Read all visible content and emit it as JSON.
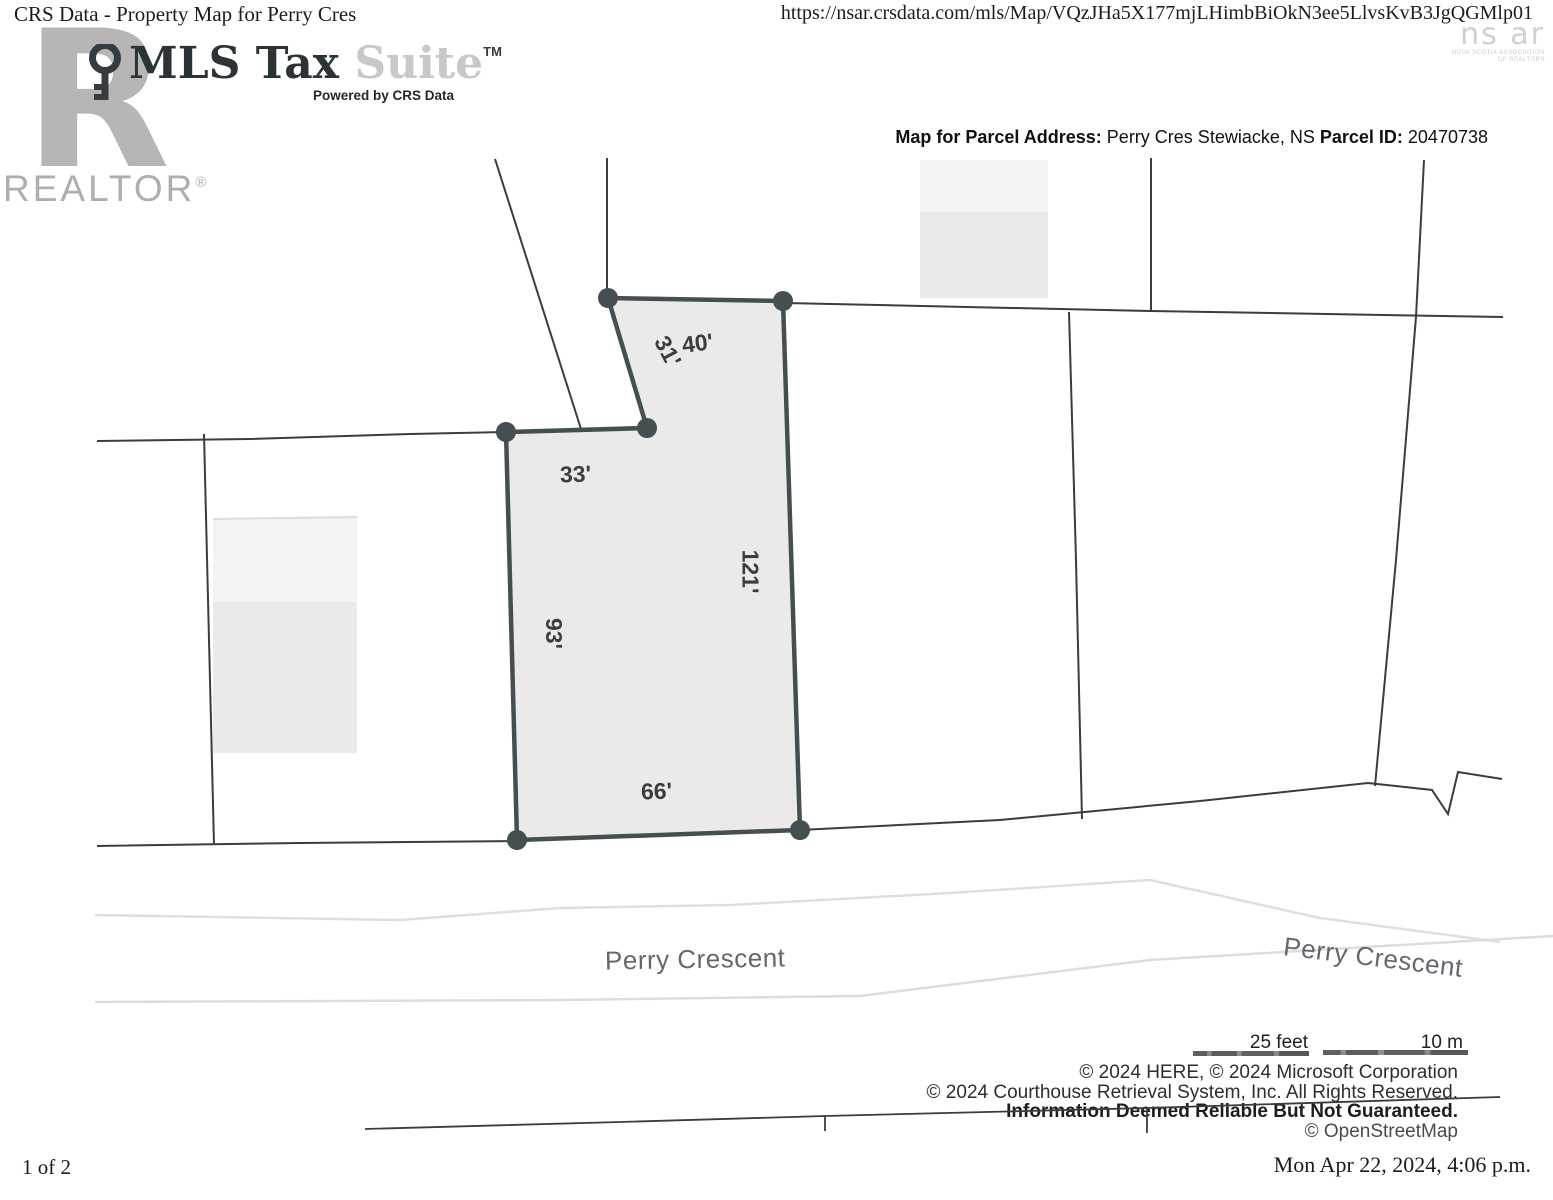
{
  "print_header": {
    "title": "CRS Data - Property Map for Perry Cres",
    "url": "https://nsar.crsdata.com/mls/Map/VQzJHa5X177mjLHimbBiOkN3ee5LlvsKvB3JgQGMlp01"
  },
  "branding": {
    "realtor_r": "R",
    "realtor_word": "REALTOR",
    "realtor_reg": "®",
    "mls_dark": "MLS Tax ",
    "mls_light": "Suite",
    "mls_tm": "TM",
    "powered_by": "Powered by CRS Data",
    "nsar_mark": "ns ar",
    "nsar_caption_line1": "NOVA SCOTIA ASSOCIATION",
    "nsar_caption_line2": "OF REALTORS"
  },
  "parcel_info": {
    "label_address": "Map for Parcel Address:",
    "address": " Perry Cres Stewiacke, NS ",
    "label_parcel_id": "Parcel ID:",
    "parcel_id": " 20470738"
  },
  "map": {
    "dim_31": "31'",
    "dim_40": "40'",
    "dim_33": "33'",
    "dim_121": "121'",
    "dim_93": "93'",
    "dim_66": "66'",
    "street_label_left": "Perry Crescent",
    "street_label_right": "Perry Crescent",
    "colors": {
      "parcel_fill": "#eaeae8",
      "parcel_outline": "#454e50",
      "boundary_line": "#3c3c3c",
      "road_edge_faint": "#dedddb"
    }
  },
  "scale_bar": {
    "feet_label": "25 feet",
    "meters_label": "10 m"
  },
  "attribution": {
    "line1": "© 2024 HERE, © 2024 Microsoft Corporation",
    "line2": "© 2024 Courthouse Retrieval System, Inc. All Rights Reserved.",
    "line3": "Information Deemed Reliable But Not Guaranteed.",
    "line4": "© OpenStreetMap"
  },
  "print_footer": {
    "page": "1 of 2",
    "timestamp": "Mon Apr 22, 2024, 4:06 p.m."
  }
}
